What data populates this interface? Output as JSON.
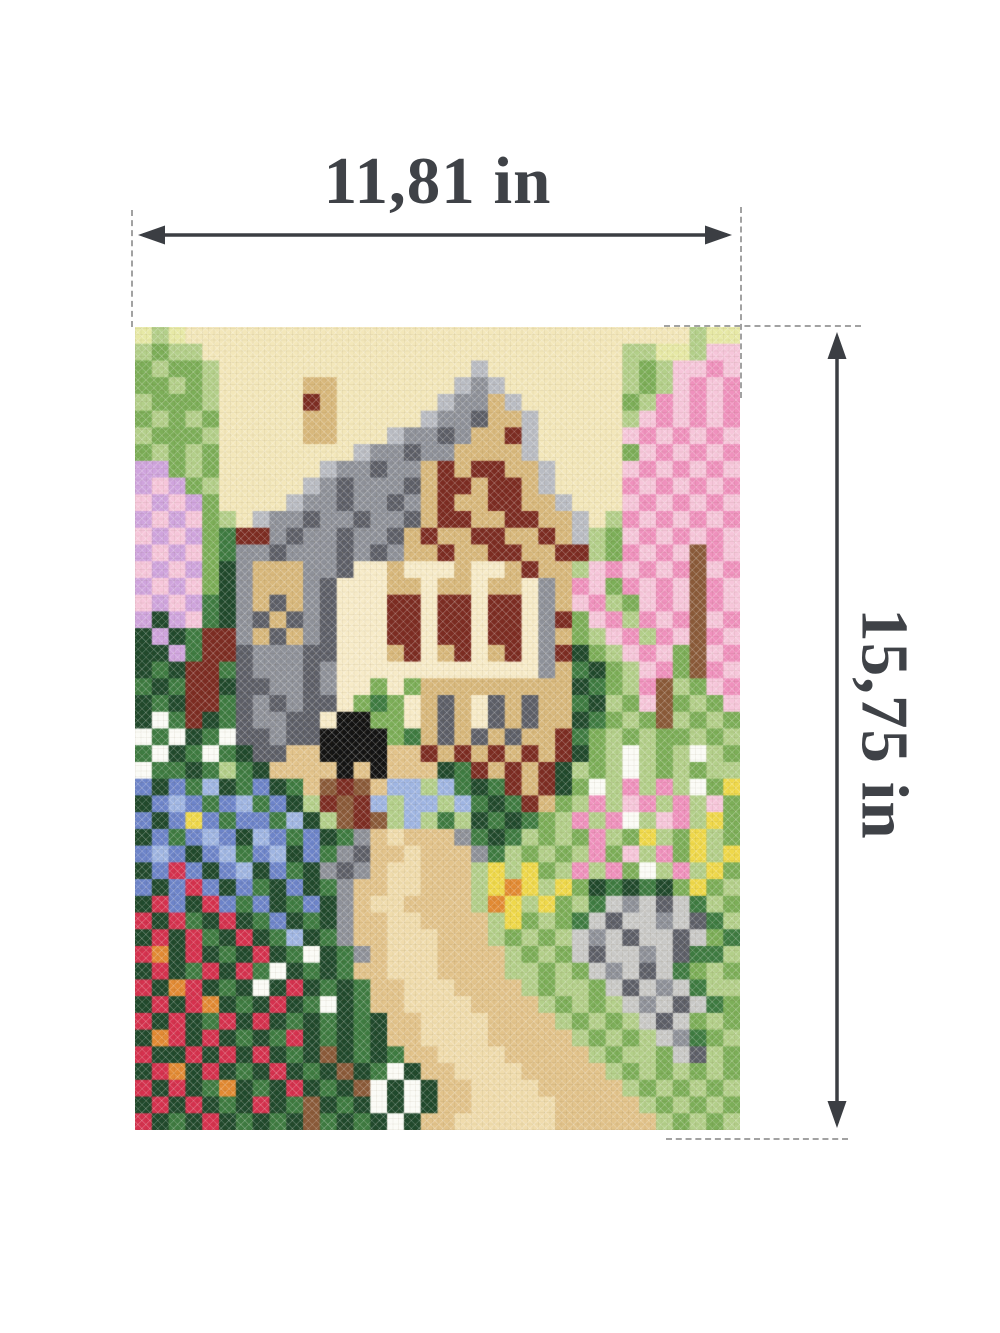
{
  "figure": {
    "width_label": "11,81 in",
    "height_label": "15,75 in"
  },
  "colors": {
    "background": "#ffffff",
    "dimension_text": "#3f4247",
    "arrow": "#3b3e43",
    "dash": "#a2a2a2"
  },
  "artwork": {
    "alt": "Cross-stitch embroidery scene: cottage with grey roof, timber-framed gable and a black cat, spring garden with lilac bush, pink blossom tree, red tulips, blue lupines, white flowers, sandy path and grey stones",
    "cols": 36,
    "rows": 48,
    "palette": {
      "Y": "#f3e7ba",
      "y": "#e7e9a6",
      "g": "#b3cf8a",
      "G": "#7cae58",
      "D": "#3e7b41",
      "d": "#20492c",
      "K": "#131313",
      "r": "#b9bcc3",
      "R": "#8e9199",
      "S": "#5d5f68",
      "c": "#c9c9c7",
      "W": "#f7ebc8",
      "w": "#fbfbf6",
      "T": "#d8b87c",
      "B": "#8a5a39",
      "M": "#7c2c22",
      "E": "#d5314e",
      "O": "#e28a33",
      "P": "#ef91bd",
      "p": "#f6c6da",
      "L": "#cfa4dd",
      "l": "#9fb5e2",
      "b": "#6d84c9",
      "n": "#efd84a",
      "t": "#e2c38b",
      "s": "#f0dcad"
    },
    "cells": [
      "ygyYYYYYYYYYYYYYYYYYYYYYYYYYYYYYYgyy",
      "gGggYYYYYYYYYYYYYYYYYYYYYYYYYggyygpp",
      "GgGGgYYYYYYYYYYYYYYYrYYYYYYYYgGgppPp",
      "GGgGgYYYYYTTYYYYYYYrRrYYYYYYYgGgpPpP",
      "gGGGgYYYYYMTYYYYYYrRRTrYYYYYYGgPpPpP",
      "GgGgGYYYYYTTYYYYYrRRSTTrYYYYYgpPpPpP",
      "gGGGgYYYYYTTYYYrRRSRTTMrYYYYYpPpPpPp",
      "GgGgGYYYYYYYYrRRSRRTTTTrYYYYYGpPpPpP",
      "LLGgGYYYYYYrRRSRRTMTMMTTrYYYYpPpPpPp",
      "LpLGgYYYYYrRSRRRSTMMTMMTrYYYYPpPpPpP",
      "pLpLGYYYYrRRSRRSRTMTTMMTTrYYYpPpPpPp",
      "LpLpGgYrRRSRRSRRSTMMTTMMTTrYgPpPpPpP",
      "pLpLGDMMRSRRSRRSTMTTMMTTMTrgGpPpPpPp",
      "LpLpGDRRSRRRSRSRTTMTTMMTTMMgGPpPpBPp",
      "pLpLGdRTTTRRSWWTWWWTWWTMTTgpPpPpPBpP",
      "LpLpGdRTTTRSWWWTTWTTWTTWRTPpGPpPpBPp",
      "pLpLDdRTSTRSWWWMMWMMWMMWRTpPgGpPpBPp",
      "LdLpDdRSTSRSWWWMMWMMWMMWRMGpPgPpPBpP",
      "dLdDMMRTSTRSWWWMMWMMWMMWRTGgpPgPpBPp",
      "ddLDMMSRRRSSWWWTMWTMWTMWRMdGgpPpGBpP",
      "dDdMMDSRRRSRWWWWWWWWWWWWRTDdGgpPGBPp",
      "DdDMMdSSRRSRWWGWGTTTTTTTTTdDGgPBgGpP",
      "dDdMMDSRSRSSWGDGWTSTWSTSTTDdgGpBGgGp",
      "dwDMdDSRRSSWKKGGWTSTWSTSTTdDGgGBgGgG",
      "wDwdDwSSRSSKKKKGDTSTSTSTTMDGgGgGGgGg",
      "DwdDwDdSSttKKKKttMTMTMTMTMdGgwgGgwgG",
      "wDDdDgDdttttKtKtttdDMTMTMdgGgwgGgGgg",
      "bdbDldDbdDtBMBtllglDdDMTMdGwgPgPgwGn",
      "dblbDblDbdgMBMlgllglDdDMTGgPgpPgPgpG",
      "bdbnbDbbDldgBMBglgDgdDdDGgPgPwgpPgnG",
      "dbDblbdlbDbdDRtstttRDdDgGgGPgGngGngG",
      "blbdblDbldbDRSttstttRDgGgGgPGpgPGngn",
      "dbEbdbldbDdRSRtsstttgngnGgPgPGwgPgnG",
      "bdbEbdbDdbdDRttsstttgnOngnGdDdDdGnGg",
      "dEbdEbDbdDbdRtssttttgOngnGgDcRcScDgG",
      "EdEDdEdDbdDdRttssttttgnGgGDcSccRcSDg",
      "dEdEDdEdDldDRttssstttgGgGgcRcSccScGD",
      "EOdEdDdEdDwdDRtsssttttgGgGcSccRcSDDg",
      "dEdDEdEDwdDdDttsssttttggGgGcRcScDGgG",
      "EdOEdDdwdEdDdDttsssttttgGggGcScRcDgg",
      "dEdEOdDdEdDwdDttssssttttgGgGgcRcScDG",
      "EdEdDEdEdDdDdDdttssssttttgGgGgcScGgG",
      "dOEdEdDdDEdDdDdttsssstttttgGgGgcRDGg",
      "EddEdEdEdDdBdDdDttsssstttttgGggGcSgG",
      "dEOdEdDdEdDdBdDwdttsssstttttgGgGgGgG",
      "EdEdDOdDdEdDdBwdwdttsssstttttgGgGgGg",
      "dEdEdDdEdDBdDdwdwdttssssstttttgGgGgG",
      "EdDdEdDdDdBDdDdwdttssssssttttttgGgGg"
    ]
  }
}
